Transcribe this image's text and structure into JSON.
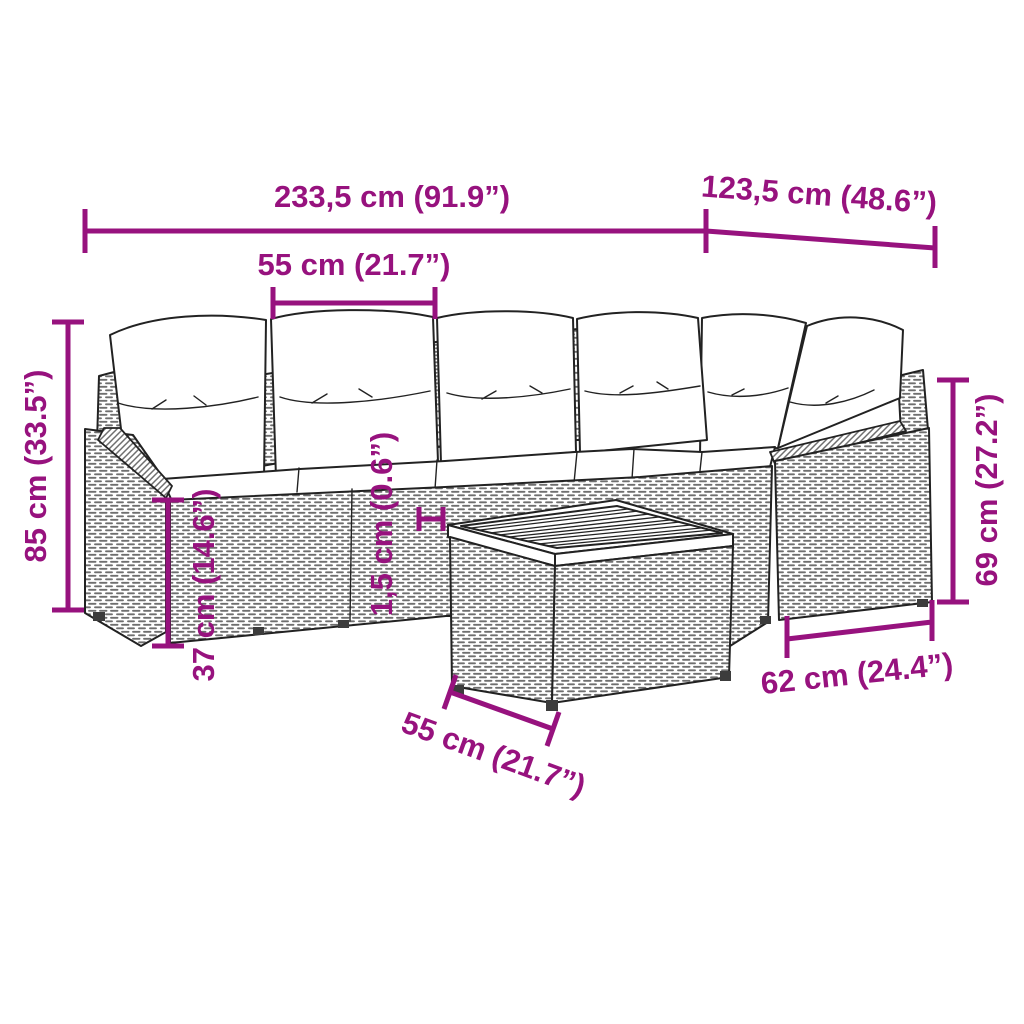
{
  "meta": {
    "accent_color": "#97127E",
    "line_color": "#222222",
    "texture_color": "#6f6f6f"
  },
  "dims": {
    "total_width": "233,5 cm (91.9”)",
    "right_depth": "123,5 cm (48.6”)",
    "seat_module_width": "55 cm (21.7”)",
    "total_height": "85 cm (33.5”)",
    "seat_height": "37 cm (14.6”)",
    "tabletop_thickness": "1,5 cm (0.6”)",
    "armrest_height": "69 cm (27.2”)",
    "armrest_depth": "62 cm (24.4”)",
    "table_width": "55 cm (21.7”)"
  }
}
